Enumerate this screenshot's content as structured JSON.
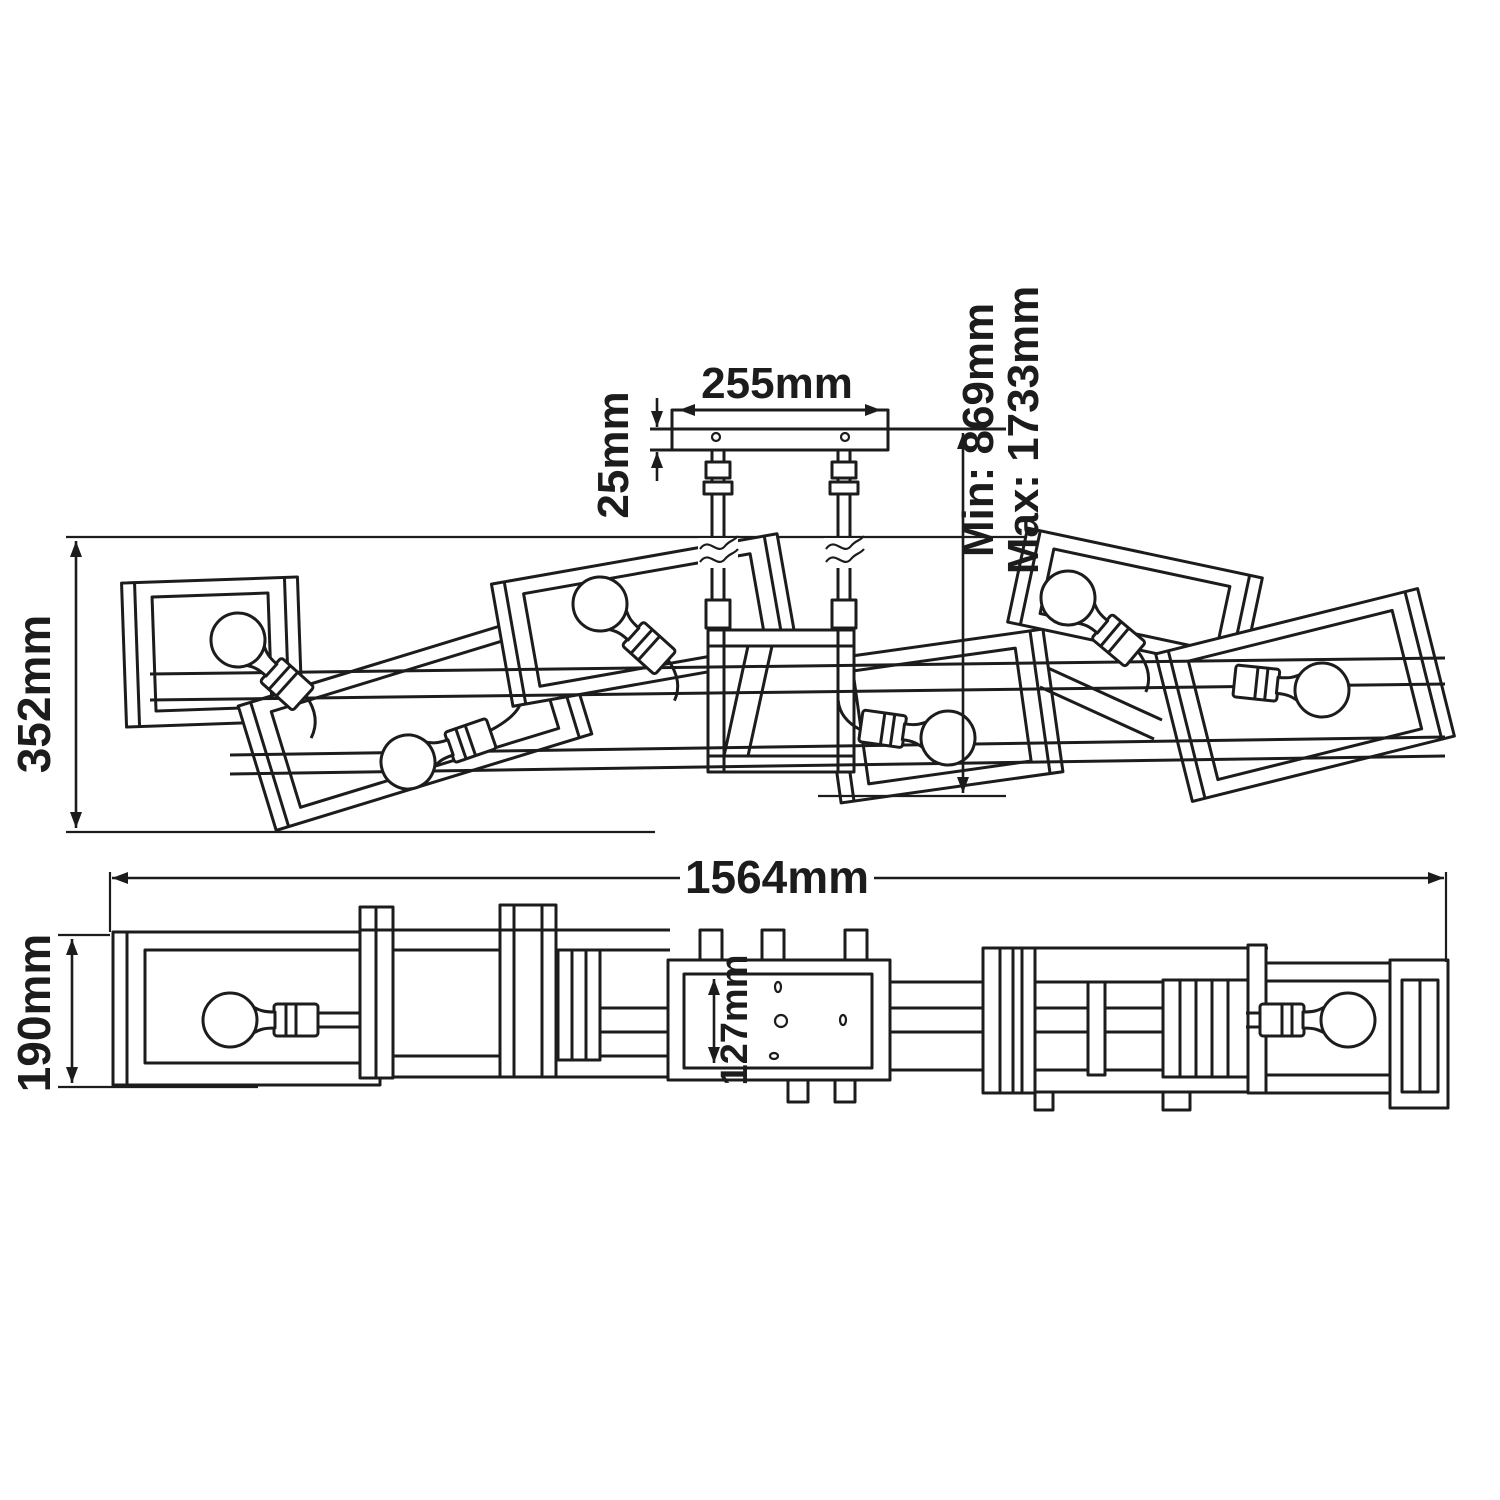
{
  "drawing": {
    "background": "#ffffff",
    "line_color": "#1c1c1c",
    "kind": "lighting-fixture dimension diagram",
    "views": {
      "plan": {
        "labels": {
          "canopy_width": "255mm",
          "canopy_depth": "25mm",
          "drop_min": "Min: 869mm",
          "drop_max": "Max: 1733mm",
          "fixture_depth": "352mm"
        }
      },
      "side": {
        "labels": {
          "fixture_length": "1564mm",
          "fixture_height": "190mm",
          "backplate_height": "127mm"
        }
      }
    }
  }
}
